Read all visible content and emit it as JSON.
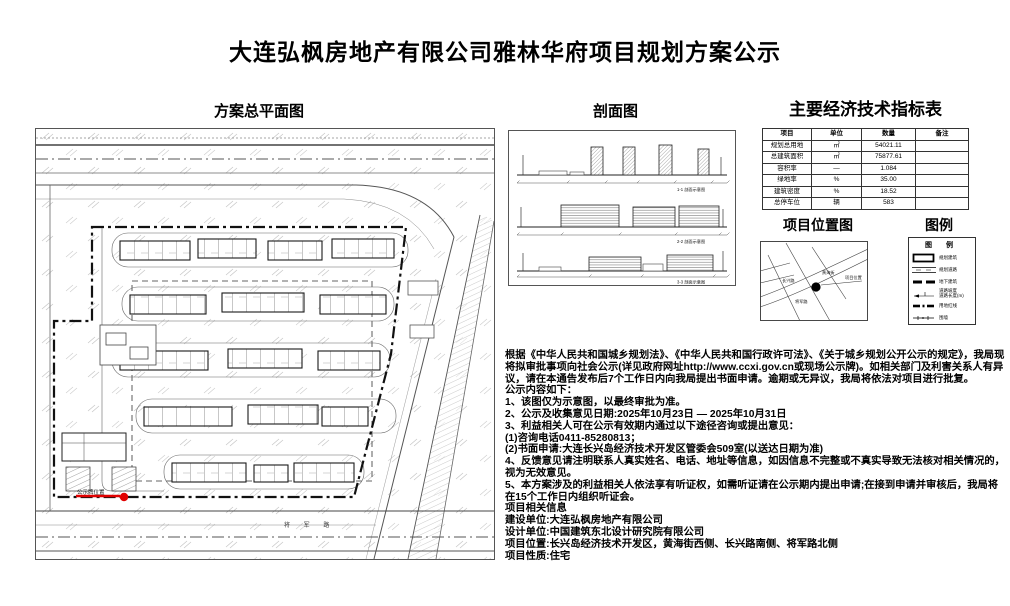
{
  "page": {
    "title": "大连弘枫房地产有限公司雅林华府项目规划方案公示"
  },
  "sections": {
    "site_plan_title": "方案总平面图",
    "section_view_title": "剖面图",
    "indicators_title": "主要经济技术指标表",
    "location_map_title": "项目位置图",
    "legend_heading": "图例"
  },
  "indicators_table": {
    "headers": [
      "项目",
      "单位",
      "数量",
      "备注"
    ],
    "rows": [
      [
        "规划总用地",
        "㎡",
        "54021.11",
        ""
      ],
      [
        "总建筑面积",
        "㎡",
        "75877.61",
        ""
      ],
      [
        "容积率",
        "—",
        "1.084",
        ""
      ],
      [
        "绿地率",
        "%",
        "35.00",
        ""
      ],
      [
        "建筑密度",
        "%",
        "18.52",
        ""
      ],
      [
        "总停车位",
        "辆",
        "583",
        ""
      ]
    ]
  },
  "site_plan": {
    "marker_label": "公示牌位置",
    "bottom_road_label": "将 军 路"
  },
  "section_view": {
    "captions": [
      "1-1 剖面示意图",
      "2-2 剖面示意图",
      "3-3 剖面示意图"
    ]
  },
  "location_map": {
    "labels": {
      "road_left": "长兴路",
      "road_top": "黄海街",
      "road_bottom": "将军路",
      "site": "项目位置"
    }
  },
  "legend": {
    "title": "图 例",
    "items": [
      "规划建筑",
      "规划道路",
      "地下建筑",
      "道路坡度\n道路长度(m)",
      "用地红线",
      "围墙"
    ]
  },
  "notice": {
    "paragraphs": [
      "根据《中华人民共和国城乡规划法》、《中华人民共和国行政许可法》、《关于城乡规划公开公示的规定》，我局现将拟审批事项向社会公示(详见政府网址http://www.ccxi.gov.cn或现场公示牌)。如相关部门及利害关系人有异议，请在本通告发布后7个工作日内向我局提出书面申请。逾期或无异议，我局将依法对项目进行批复。",
      "公示内容如下：",
      "1、该图仅为示意图，以最终审批为准。",
      "2、公示及收集意见日期:2025年10月23日 — 2025年10月31日",
      "3、利益相关人可在公示有效期内通过以下途径咨询或提出意见：",
      "(1)咨询电话0411-85280813；",
      "(2)书面申请:大连长兴岛经济技术开发区管委会509室(以送达日期为准)",
      "4、反馈意见请注明联系人真实姓名、电话、地址等信息，如因信息不完整或不真实导致无法核对相关情况的，视为无效意见。",
      "5、本方案涉及的利益相关人依法享有听证权，如需听证请在公示期内提出申请;在接到申请并审核后，我局将在15个工作日内组织听证会。",
      "项目相关信息",
      "建设单位:大连弘枫房地产有限公司",
      "设计单位:中国建筑东北设计研究院有限公司",
      "项目位置:长兴岛经济技术开发区，黄海街西侧、长兴路南侧、将军路北侧",
      "项目性质:住宅"
    ]
  }
}
